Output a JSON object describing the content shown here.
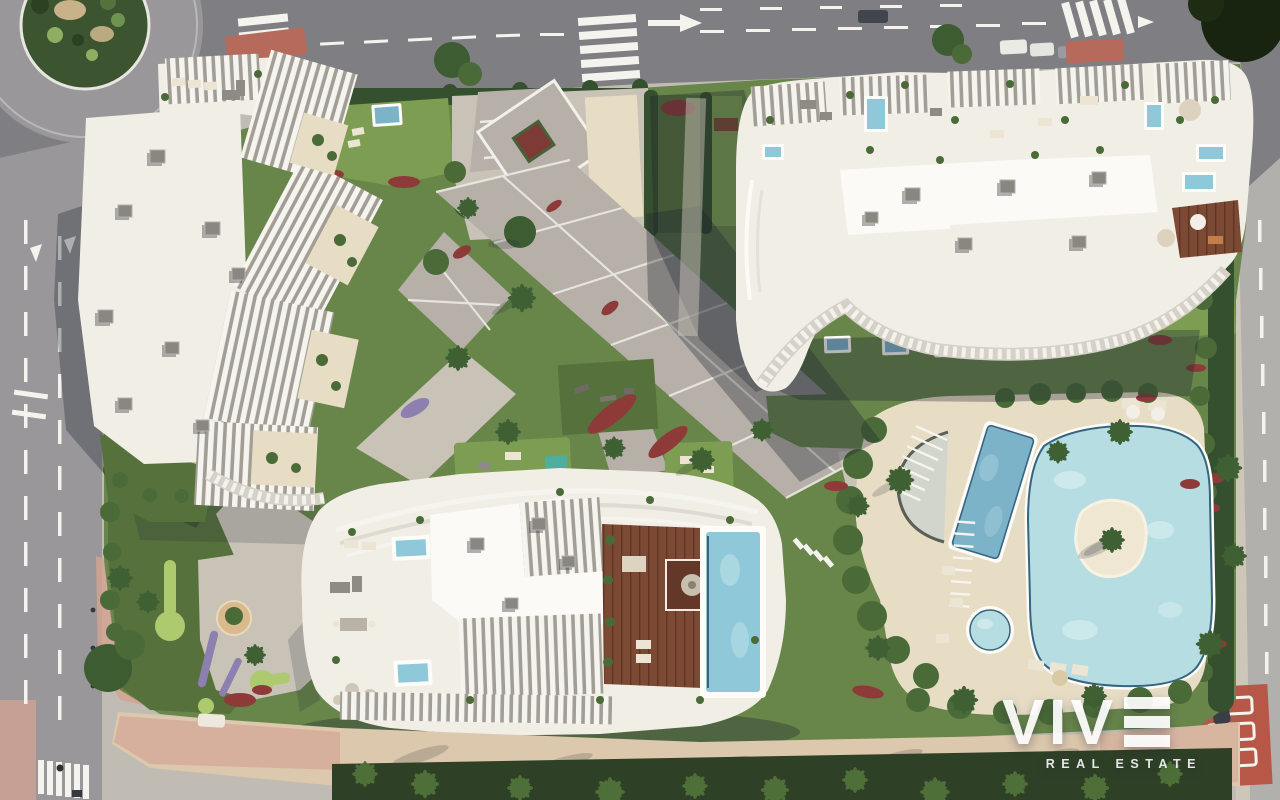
{
  "watermark": {
    "brand": "VIVE",
    "brand_text_part": "VIV",
    "brand_stylized_letter": "E",
    "tagline": "REAL ESTATE"
  },
  "scene": {
    "features": [
      "roundabout",
      "top road",
      "left road",
      "right road",
      "north apartment building",
      "northeast apartment building",
      "south apartment building",
      "central paved plaza",
      "lap pool",
      "leisure pool with island",
      "kids pool",
      "rooftop pool",
      "wooden rooftop deck",
      "mini-golf garden",
      "promenade with palm trees",
      "red bike crossing",
      "zebra crosswalks"
    ]
  },
  "palette": {
    "asphalt_dark": "#7f7e82",
    "asphalt_mid": "#999799",
    "asphalt_light": "#b2b0ad",
    "sidewalk": "#cdc7ba",
    "sidewalk_gray": "#c0bcb4",
    "paver": "#b6b0a8",
    "paver_light": "#c8c2b7",
    "lawn": "#68854a",
    "lawn_bright": "#7d9e52",
    "lawn_dark": "#57713c",
    "hedge": "#35502e",
    "bush": "#4a6a38",
    "tree": "#3d5c31",
    "putting_green": "#aeca6e",
    "pool_light": "#b6dde2",
    "pool_mid": "#7cb3c9",
    "pool_dark": "#35657f",
    "pool_rooftop": "#8fc8d8",
    "deck_sand": "#e7ddc5",
    "building_white": "#f1eee6",
    "building_bright": "#fbfaf6",
    "building_shade": "#d8d3ca",
    "fin_gap": "#a29d95",
    "wood": "#7c4a34",
    "wood_dark": "#643828",
    "flower_red": "#8e3a38",
    "lavender": "#8d80b0",
    "terracotta": "#b56a5b",
    "bike_red": "#b65748",
    "promenade_sand": "#dcc8ad",
    "promenade_pink": "#d2a393",
    "marking": "#f4f3ee",
    "shadow": "#1b2330"
  }
}
